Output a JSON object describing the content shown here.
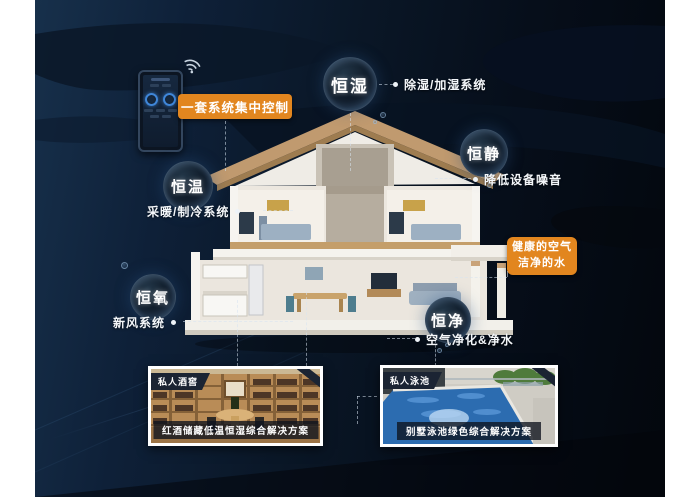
{
  "stage": {
    "control_label": "一套系统集中控制",
    "highlight_line1": "健康的空气",
    "highlight_line2": "洁净的水"
  },
  "bubbles": {
    "humidity": {
      "label": "恒湿",
      "note": "除湿/加湿系统"
    },
    "quiet": {
      "label": "恒静",
      "note": "降低设备噪音"
    },
    "temperature": {
      "label": "恒温",
      "note": "采暖/制冷系统"
    },
    "oxygen": {
      "label": "恒氧",
      "note": "新风系统"
    },
    "purity": {
      "label": "恒净",
      "note": "空气净化&净水"
    }
  },
  "photos": {
    "wine_cellar": {
      "badge": "私人酒窖",
      "caption": "红酒储藏低温恒湿综合解决方案"
    },
    "pool": {
      "badge": "私人泳池",
      "caption": "别墅泳池绿色综合解决方案"
    }
  },
  "colors": {
    "accent_orange": "#e2861f",
    "background_navy": "#0e1c2e",
    "bubble_rim": "#96bee6"
  }
}
